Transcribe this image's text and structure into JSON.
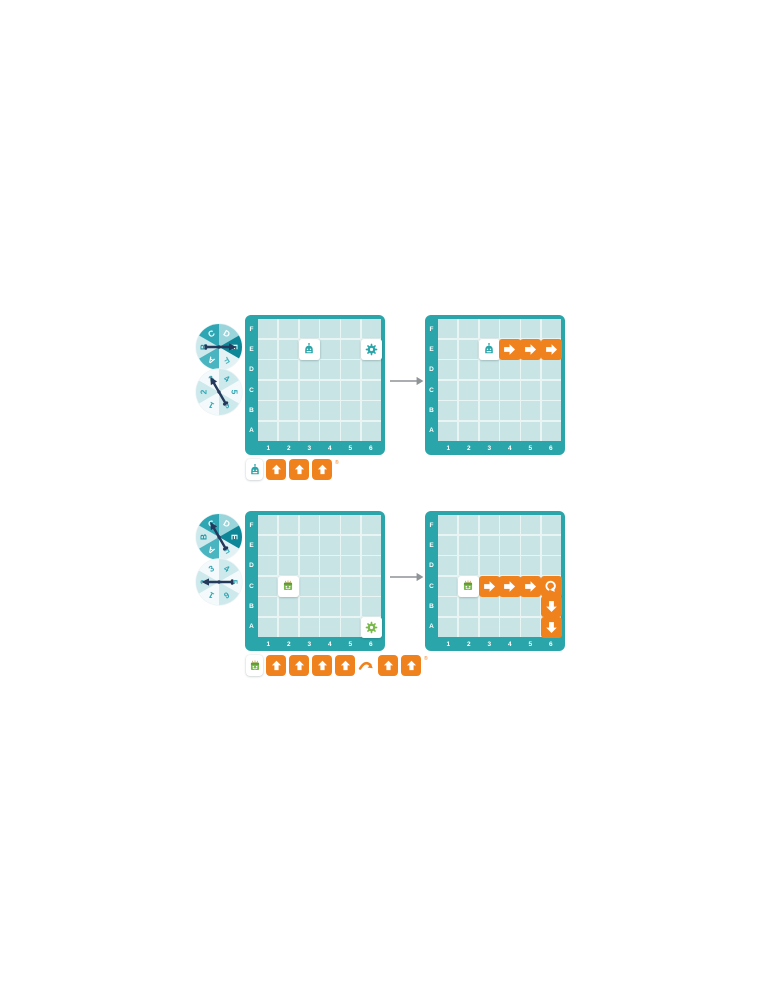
{
  "grid": {
    "rows": [
      "F",
      "E",
      "D",
      "C",
      "B",
      "A"
    ],
    "cols": [
      "1",
      "2",
      "3",
      "4",
      "5",
      "6"
    ]
  },
  "examples": [
    {
      "letter_spinner": {
        "labels": [
          "A",
          "B",
          "C",
          "D",
          "E",
          "F"
        ],
        "selected": "E"
      },
      "number_spinner": {
        "labels": [
          "1",
          "2",
          "3",
          "4",
          "5",
          "6"
        ],
        "selected": "3"
      },
      "before_grid": {
        "tiles": [
          {
            "row": "E",
            "col": 3,
            "type": "robot-teal"
          },
          {
            "row": "E",
            "col": 6,
            "type": "gear-teal"
          }
        ]
      },
      "after_grid": {
        "tiles": [
          {
            "row": "E",
            "col": 3,
            "type": "robot-teal"
          },
          {
            "row": "E",
            "col": 4,
            "type": "arrow-right"
          },
          {
            "row": "E",
            "col": 5,
            "type": "arrow-right"
          },
          {
            "row": "E",
            "col": 6,
            "type": "arrow-right"
          }
        ]
      },
      "commands": [
        "robot-teal",
        "forward",
        "forward",
        "forward"
      ],
      "registered_mark": "®"
    },
    {
      "letter_spinner": {
        "labels": [
          "A",
          "B",
          "C",
          "D",
          "E",
          "F"
        ],
        "selected": "C"
      },
      "number_spinner": {
        "labels": [
          "1",
          "2",
          "3",
          "4",
          "5",
          "6"
        ],
        "selected": "2"
      },
      "before_grid": {
        "tiles": [
          {
            "row": "C",
            "col": 2,
            "type": "robot-green"
          },
          {
            "row": "A",
            "col": 6,
            "type": "gear-green"
          }
        ]
      },
      "after_grid": {
        "tiles": [
          {
            "row": "C",
            "col": 2,
            "type": "robot-green"
          },
          {
            "row": "C",
            "col": 3,
            "type": "arrow-right"
          },
          {
            "row": "C",
            "col": 4,
            "type": "arrow-right"
          },
          {
            "row": "C",
            "col": 5,
            "type": "arrow-right"
          },
          {
            "row": "C",
            "col": 6,
            "type": "turn-right"
          },
          {
            "row": "B",
            "col": 6,
            "type": "arrow-down"
          },
          {
            "row": "A",
            "col": 6,
            "type": "arrow-down"
          }
        ]
      },
      "commands": [
        "robot-green",
        "forward",
        "forward",
        "forward",
        "forward",
        "turn-right",
        "forward",
        "forward"
      ],
      "registered_mark": "®"
    }
  ],
  "colors": {
    "teal": "#2AA5A9",
    "cell": "#C9E4E5",
    "cell_line": "#E9F5F5",
    "orange": "#F0821E",
    "green": "#79B949",
    "green_dark": "#5C9A33",
    "navy": "#24395B",
    "gray_arrow": "#8F9497",
    "white": "#FFFFFF",
    "letter_wedges": [
      "#49B5C1",
      "#CDE9EC",
      "#2FA6B4",
      "#9BD5DC",
      "#0D8798",
      "#E2F1F3"
    ],
    "letter_text": [
      "#FFFFFF",
      "#1D97A6",
      "#FFFFFF",
      "#FFFFFF",
      "#FFFFFF",
      "#4AB5C1"
    ],
    "number_wedges": [
      "#F4FAFB",
      "#CDE9EC",
      "#F4FAFB",
      "#CDE9EC",
      "#F4FAFB",
      "#CDE9EC"
    ],
    "number_text": [
      "#2FA6B4",
      "#2FA6B4",
      "#2FA6B4",
      "#2FA6B4",
      "#2FA6B4",
      "#2FA6B4"
    ]
  }
}
